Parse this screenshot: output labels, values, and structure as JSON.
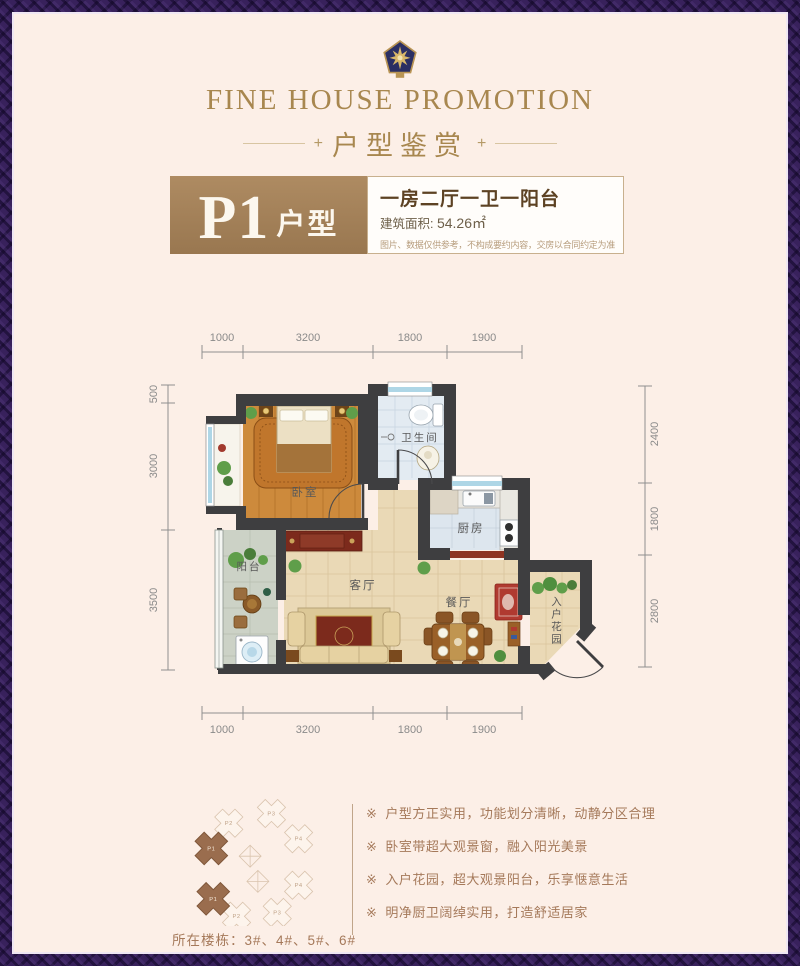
{
  "header": {
    "emblem": "crest-star-icon",
    "title_en": "FINE HOUSE PROMOTION",
    "title_cn": "户型鉴赏",
    "plus": "+"
  },
  "unit_badge": {
    "code": "P1",
    "suffix": "户型"
  },
  "unit_info": {
    "headline": "一房二厅一卫一阳台",
    "area_label": "建筑面积:",
    "area_value": "54.26㎡",
    "disclaimer": "图片、数据仅供参考，不构成要约内容，交房以合同约定为准"
  },
  "floorplan": {
    "rooms": {
      "bedroom": "卧室",
      "bathroom": "卫生间",
      "kitchen": "厨房",
      "living": "客厅",
      "dining": "餐厅",
      "balcony": "阳台",
      "garden": "入户花园"
    },
    "dims": {
      "top": [
        "1000",
        "3200",
        "1800",
        "1900"
      ],
      "bottom": [
        "1000",
        "3200",
        "1800",
        "1900"
      ],
      "left": [
        "500",
        "3000",
        "3500"
      ],
      "right": [
        "2400",
        "1800",
        "2800"
      ]
    }
  },
  "location": {
    "units": [
      "P2",
      "P3",
      "P4",
      "P1",
      "P1",
      "P2",
      "P3",
      "P4"
    ],
    "caption": "所在楼栋：3#、4#、5#、6#"
  },
  "features": {
    "bullet": "※",
    "items": [
      "户型方正实用，功能划分清晰，动静分区合理",
      "卧室带超大观景窗，融入阳光美景",
      "入户花园，超大观景阳台，乐享惬意生活",
      "明净厨卫阔绰实用，打造舒适居家"
    ]
  },
  "colors": {
    "border_purple": "#38215c",
    "background_cream": "#fcefe7",
    "brand_gold": "#a8874f",
    "badge_brown": "#a38258",
    "headline_brown": "#5d4223",
    "wall_dark": "#3e3e40",
    "wood_floor": "#cd8a3c",
    "tile_beige": "#ead9b6",
    "tile_blue": "#dfe8f0",
    "accent_red": "#7c2a1c",
    "text_brown": "#a5795a"
  }
}
